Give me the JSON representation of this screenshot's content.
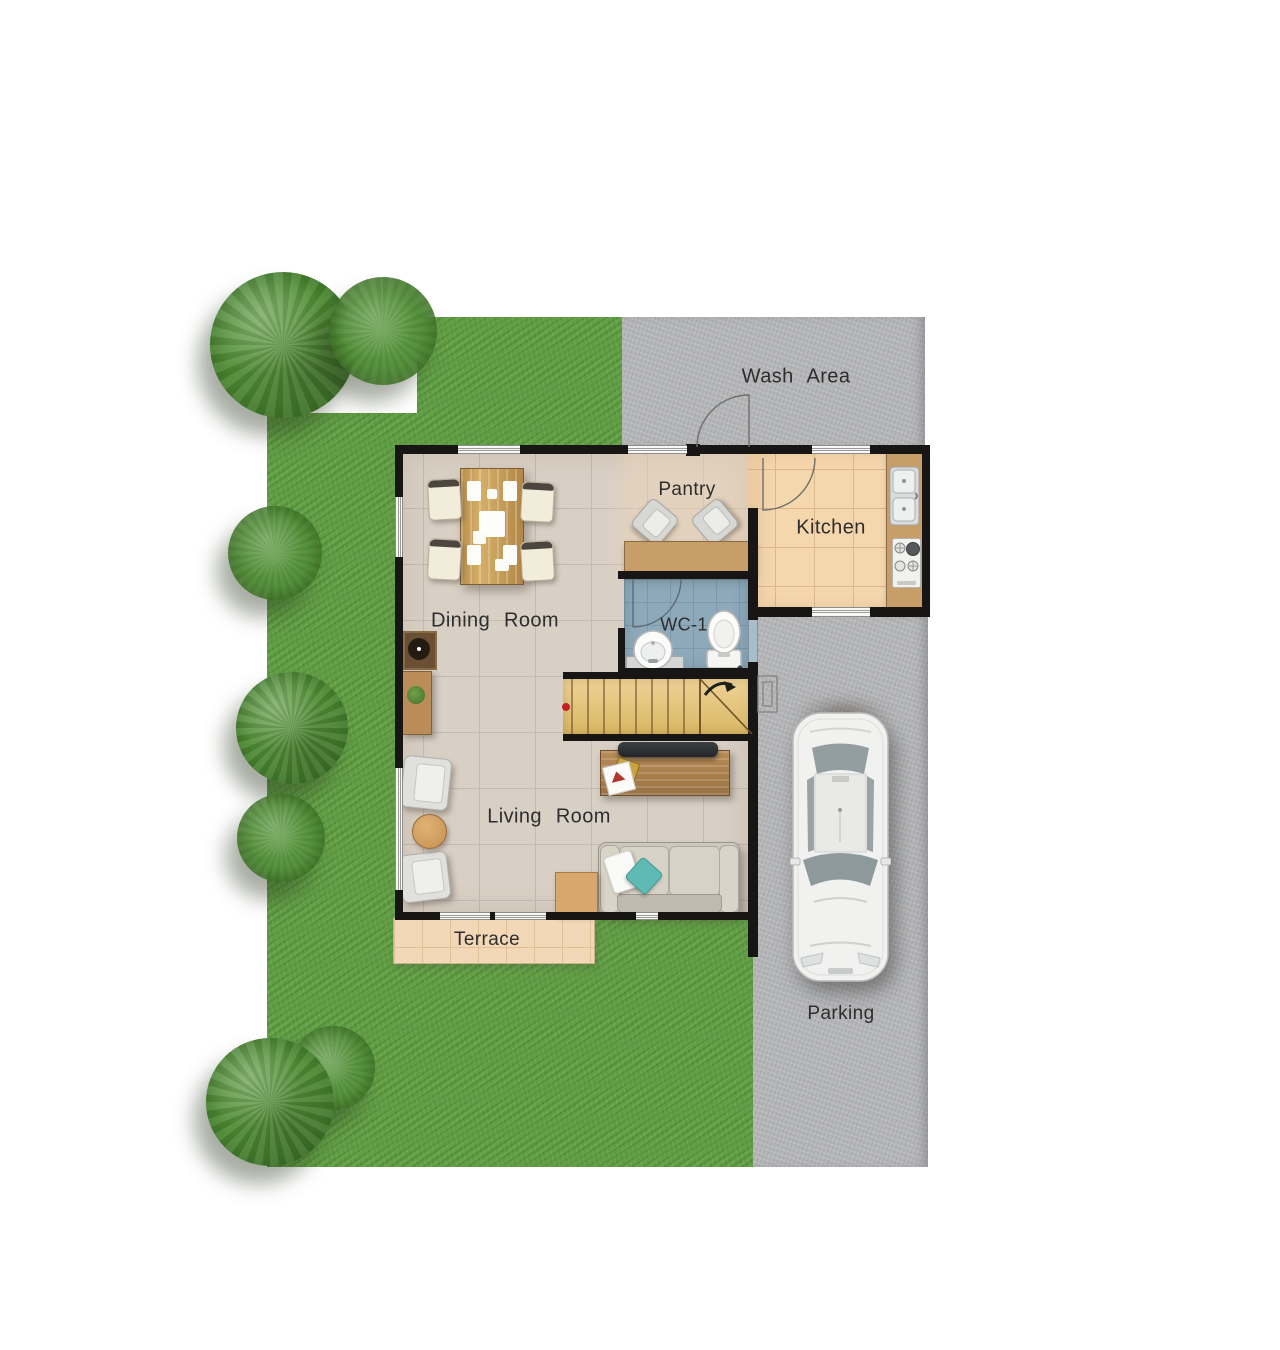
{
  "title": "House Ground Floor Plan",
  "labels": {
    "wash_area": "Wash Area",
    "pantry": "Pantry",
    "kitchen": "Kitchen",
    "dining_room": "Dining Room",
    "wc1": "WC-1",
    "living_room": "Living Room",
    "terrace": "Terrace",
    "parking": "Parking"
  },
  "colors": {
    "grass": "#5f9c43",
    "concrete": "#b4b5b7",
    "wall": "#181614",
    "floor": "#d9d0c5",
    "floor_line": "#c3bab0",
    "kitchen_floor": "#f5d7ae",
    "kitchen_line": "#dcb88c",
    "wc_floor": "#8ea9ba",
    "wc_line": "#7b99ab",
    "terrace_floor": "#f2d8b6",
    "terrace_line": "#e0c096",
    "counter": "#c79e68",
    "chair_col": "#f2ecda",
    "sofa_col": "#cdc8bc",
    "pillow_accent": "#5fbab6",
    "side_table": "#d8a76c",
    "label_text": "#2d2d2d",
    "car_body": "#f1f1ef",
    "stair_wood": "#e8c77e"
  }
}
